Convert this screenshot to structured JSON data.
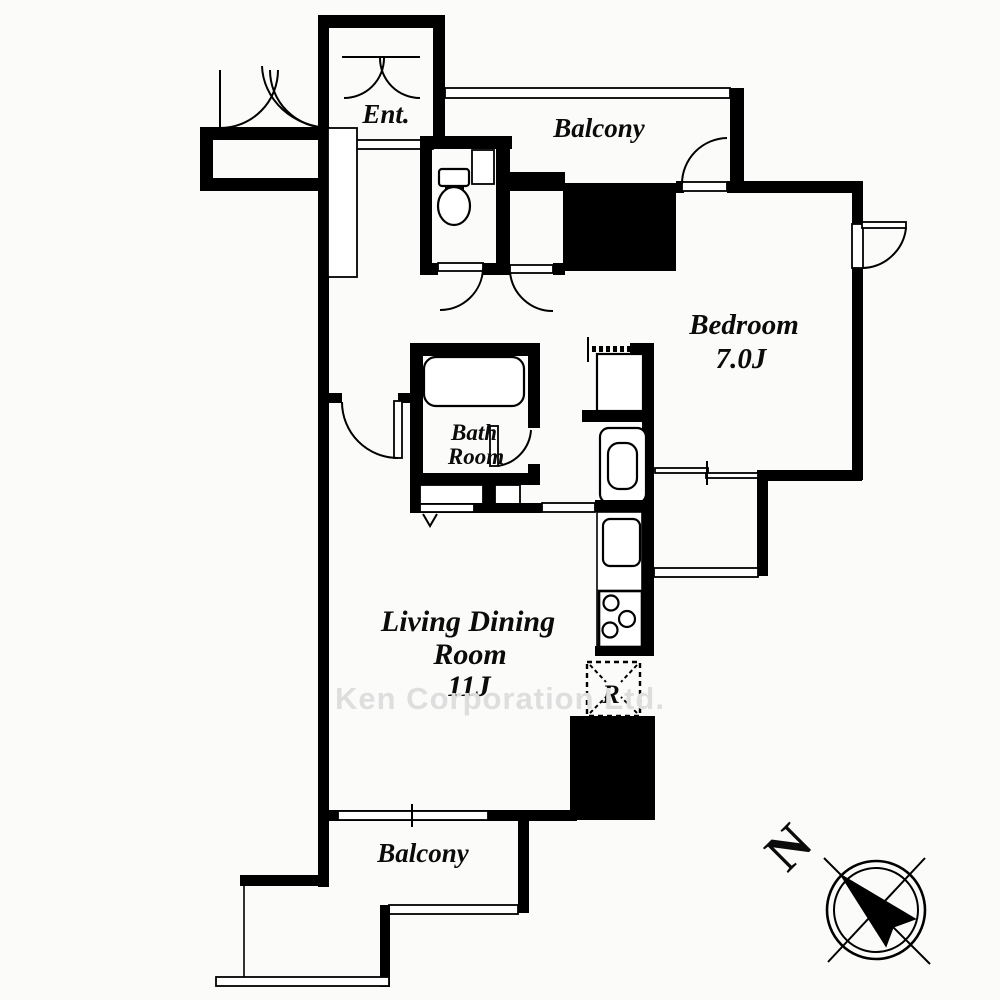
{
  "document": {
    "type": "apartment-floor-plan",
    "units": "Japanese tatami-count room sizes (J)"
  },
  "rooms": {
    "entrance": {
      "label": "Ent."
    },
    "balcony_top": {
      "label": "Balcony"
    },
    "balcony_bottom": {
      "label": "Balcony"
    },
    "bedroom": {
      "name": "Bedroom",
      "size": "7.0J"
    },
    "bathroom": {
      "line1": "Bath",
      "line2": "Room"
    },
    "living_dining": {
      "line1": "Living Dining",
      "line2": "Room",
      "size": "11J"
    }
  },
  "kitchen": {
    "refrigerator_label": "R"
  },
  "compass": {
    "north": "N"
  },
  "watermark": "Ken Corporation Ltd.",
  "fixtures": [
    "toilet-icon",
    "bathtub-icon",
    "washing-machine-pan-icon",
    "washbasin-icon",
    "kitchen-sink-icon",
    "stove-3-burner-icon",
    "refrigerator-space-icon",
    "door-swing-arcs",
    "sliding-window-symbols",
    "compass-needle-icon"
  ],
  "colors": {
    "wall": "#000000",
    "floor": "#fbfbf9",
    "line": "#000000",
    "watermark_gray": "#dedede"
  }
}
